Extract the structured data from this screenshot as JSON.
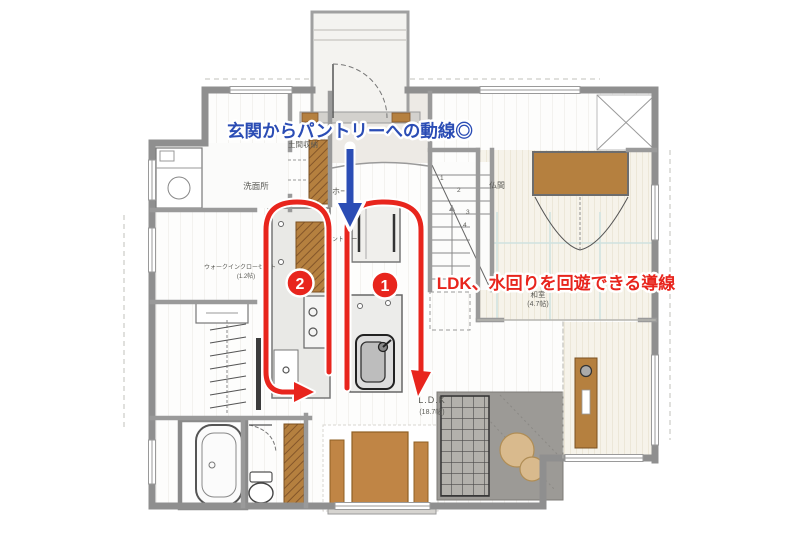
{
  "annotations": {
    "blue_note": "玄関からパントリーへの動線◎",
    "red_note": "LDK、水回りを回遊できる導線",
    "marker_1": "1",
    "marker_2": "2"
  },
  "rooms": {
    "washroom": "洗面所",
    "doma_storage": "土間収納",
    "hall": "ホール",
    "pantry": "パントリー",
    "butsuma": "仏間",
    "washitsu": "和室",
    "washitsu_size": "(4.7帖)",
    "ldk": "L.D.K",
    "ldk_size": "(18.7帖)",
    "wic": "ウォークインクローゼット",
    "wic_size": "(1.2帖)"
  },
  "stairs": {
    "steps": [
      "1",
      "2",
      "3",
      "4"
    ]
  },
  "colors": {
    "blue_annotation": "#2b4db5",
    "red_annotation": "#e8251d",
    "wall_grey": "#8f8f8f",
    "wood_brown": "#b5803f",
    "furniture_brown": "#c08545",
    "tatami_cream": "#f6f3ea",
    "rug_grey": "#9c9a96",
    "table_tan": "#d9ba8d"
  }
}
